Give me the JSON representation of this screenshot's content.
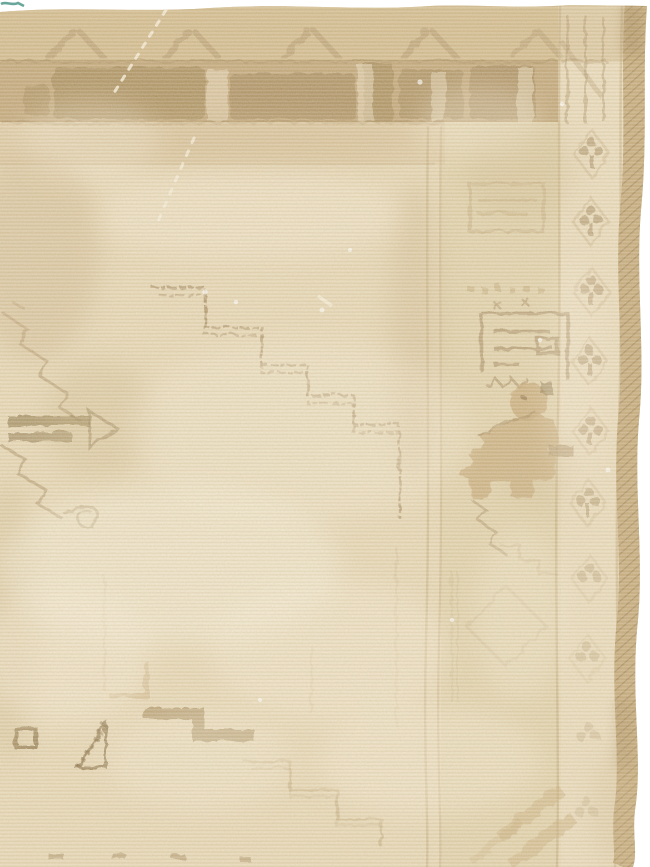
{
  "meta": {
    "subject": "faded-antique-hand-knotted-rug-corner-photograph",
    "orientation": "top-right corner of rug visible, white photo background at top and right edges"
  },
  "palette": {
    "photo_bg": "#ffffff",
    "field": "#e7d8b6",
    "field_light": "#f1e6ca",
    "field_warm": "#d9c498",
    "band_outer": "#d0b98b",
    "band_inner": "#bb9f70",
    "band_motif": "#977b4a",
    "motif_dark": "#866d41",
    "motif_mid": "#a1865a",
    "motif_faint": "#c0a779",
    "motif_tan": "#c8ab7b",
    "selvage": "#c2a674",
    "shadow_tan": "#cbb286",
    "wear_white": "#f9f1dd",
    "teal": "#4f968b"
  },
  "motifs": [
    "chevron-guard-band",
    "blocky-main-top-border",
    "stepped-medallion-outline",
    "latch-hook-medallion-arm",
    "key-spiral-motif",
    "animal-figure-motif",
    "trefoil-clover-guard-stripe",
    "serrated-triangle-motif",
    "hollow-square-motif",
    "stepped-bar-motif",
    "diagonal-hatched-selvage",
    "white-abrash-wear-lines",
    "teal-thread-mark"
  ]
}
